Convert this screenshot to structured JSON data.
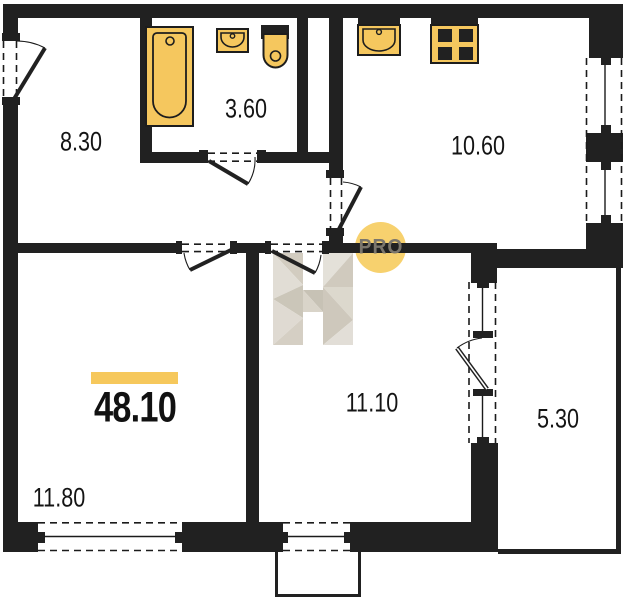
{
  "floorplan": {
    "total_area": "48.10",
    "rooms": [
      {
        "id": "hallway",
        "area": "8.30"
      },
      {
        "id": "bathroom",
        "area": "3.60"
      },
      {
        "id": "kitchen",
        "area": "10.60"
      },
      {
        "id": "living-room",
        "area": "11.80"
      },
      {
        "id": "bedroom",
        "area": "11.10"
      },
      {
        "id": "balcony",
        "area": "5.30"
      }
    ],
    "watermark": {
      "badge": "PRO"
    },
    "fixtures": [
      "bathtub",
      "bathroom-sink",
      "toilet",
      "kitchen-sink",
      "stove"
    ],
    "colors": {
      "wall": "#212121",
      "fixture_yellow": "#f5c75e",
      "accent_bar_yellow": "#f6c85c",
      "badge_yellow": "#f6ce63",
      "badge_text": "#7b766c"
    }
  }
}
